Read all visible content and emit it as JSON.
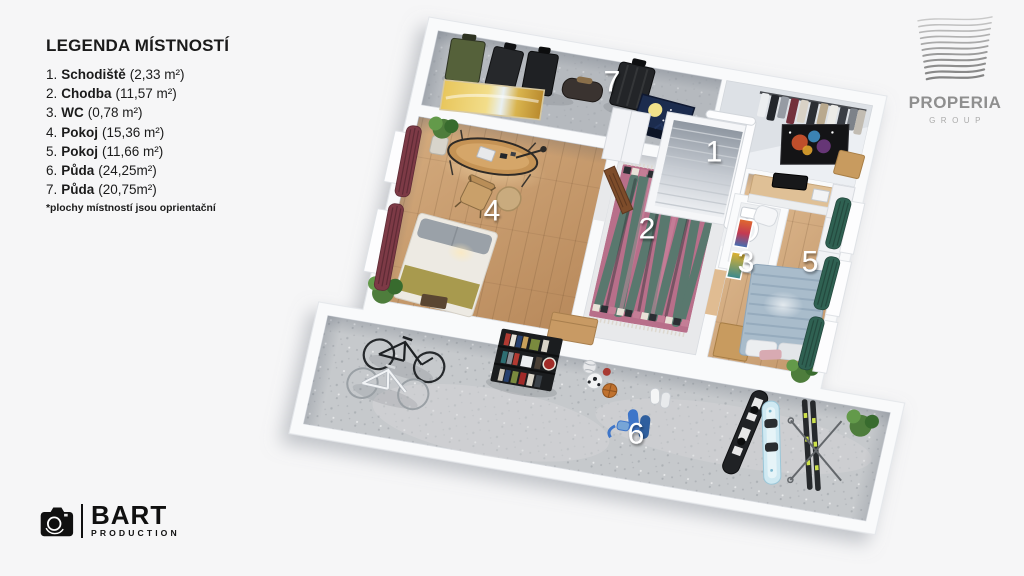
{
  "legend": {
    "title": "LEGENDA MÍSTNOSTÍ",
    "items": [
      {
        "num": "1.",
        "name": "Schodiště",
        "area": "(2,33 m²)"
      },
      {
        "num": "2.",
        "name": "Chodba",
        "area": "(11,57 m²)"
      },
      {
        "num": "3.",
        "name": "WC",
        "area": "(0,78 m²)"
      },
      {
        "num": "4.",
        "name": "Pokoj",
        "area": "(15,36 m²)"
      },
      {
        "num": "5.",
        "name": "Pokoj",
        "area": "(11,66 m²)"
      },
      {
        "num": "6.",
        "name": "Půda",
        "area": "(24,25m²)"
      },
      {
        "num": "7.",
        "name": "Půda",
        "area": "(20,75m²)"
      }
    ],
    "footnote": "*plochy místností jsou oprientační"
  },
  "plan": {
    "rooms": [
      {
        "number": "1",
        "name": "Schodiště"
      },
      {
        "number": "2",
        "name": "Chodba"
      },
      {
        "number": "3",
        "name": "WC"
      },
      {
        "number": "4",
        "name": "Pokoj"
      },
      {
        "number": "5",
        "name": "Pokoj"
      },
      {
        "number": "6",
        "name": "Půda"
      },
      {
        "number": "7",
        "name": "Půda"
      }
    ]
  },
  "logos": {
    "properia": {
      "title": "PROPERIA",
      "subtitle": "GROUP"
    },
    "bart": {
      "title": "BART",
      "subtitle": "PRODUCTION"
    }
  },
  "colors": {
    "background": "#f6f6f7",
    "wall": "#f9fafb",
    "wood_floor": "#c9a06d",
    "concrete_floor": "#c6c9cc",
    "carpet_floor": "#b5b9be",
    "hall_floor": "#e8e9eb",
    "rug_pink": "#b86f8a",
    "rug_green": "#4c7a6a",
    "curtain_maroon": "#7d3a46",
    "curtain_green": "#2f6152",
    "room_number_text": "#ffffff",
    "legend_text": "#1b1b1b",
    "logo_gray": "#8f8f8f"
  }
}
